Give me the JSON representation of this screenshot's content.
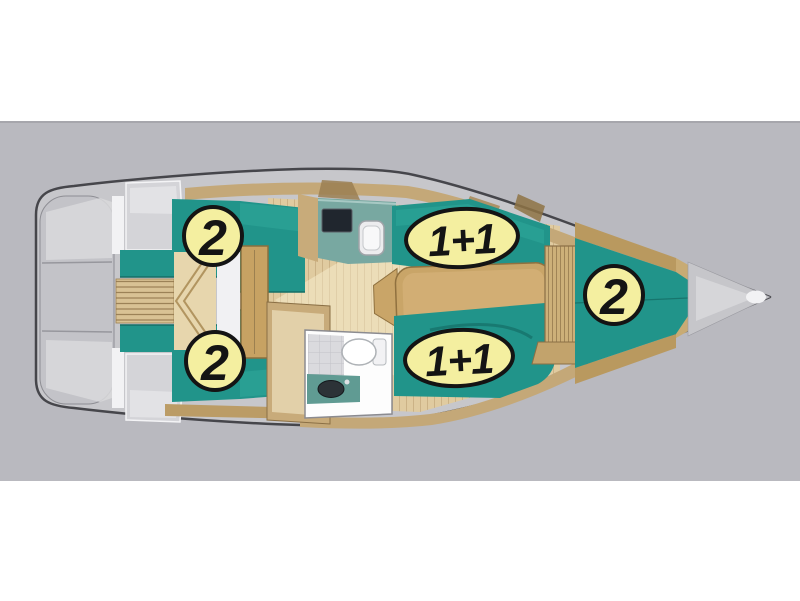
{
  "canvas": {
    "page_color": "#ffffff",
    "backdrop_color": "#b9b9bf"
  },
  "diagram": {
    "type": "sailboat-interior-deck-plan",
    "badges": [
      {
        "area": "aft-cabin-port",
        "label": "2"
      },
      {
        "area": "saloon-dinette",
        "label": "1+1"
      },
      {
        "area": "forward-cabin",
        "label": "2"
      },
      {
        "area": "aft-cabin-starboard",
        "label": "2"
      },
      {
        "area": "saloon-settee",
        "label": "1+1"
      }
    ],
    "colors": {
      "badge_fill": "#f4efa0",
      "badge_border": "#141414",
      "upholstery_teal": "#21948a",
      "wood_floor": "#e0cba0",
      "wood_furniture": "#c9a568",
      "hull_deck": "#c7c7cb",
      "hull_outline": "#46464b"
    },
    "icons": {
      "cooktop-icon": "dark rectangle on galley counter",
      "sink-icon": "white rounded rectangle on galley counter",
      "toilet-icon": "white oval bowl with cistern",
      "washbasin-icon": "dark oval basin on teal counter",
      "companionway-steps-icon": "wood treads with chevron"
    }
  }
}
